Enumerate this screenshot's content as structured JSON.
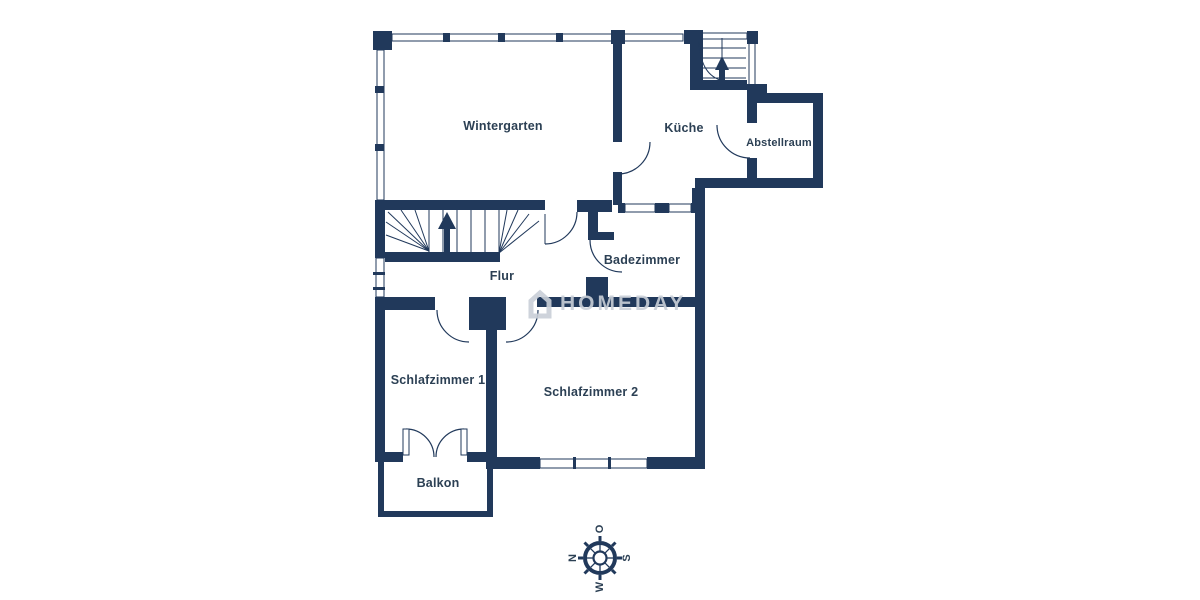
{
  "rooms": [
    {
      "label": "Wintergarten"
    },
    {
      "label": "Küche"
    },
    {
      "label": "Abstellraum"
    },
    {
      "label": "Badezimmer"
    },
    {
      "label": "Flur"
    },
    {
      "label": "Schlafzimmer 1"
    },
    {
      "label": "Schlafzimmer 2"
    },
    {
      "label": "Balkon"
    }
  ],
  "compass": {
    "north": "N",
    "east": "O",
    "south": "S",
    "west": "W"
  },
  "watermark": {
    "text": "HOMEDAY"
  },
  "colors": {
    "wall": "#21395B",
    "label": "#2C4054",
    "watermark": "#C9CFD8",
    "background": "#FFFFFF"
  }
}
